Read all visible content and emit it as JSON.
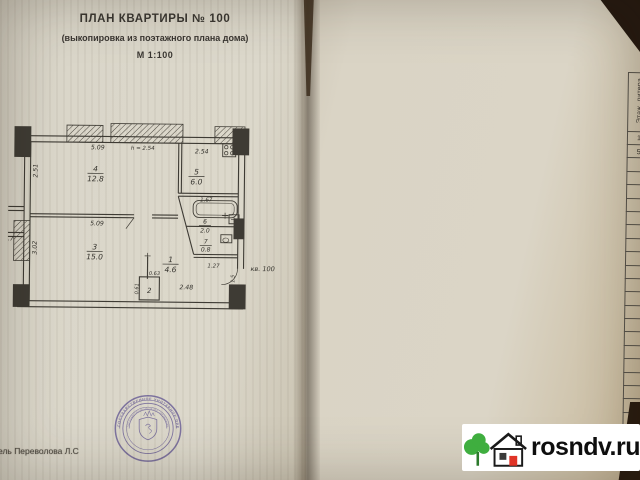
{
  "left_page": {
    "title": "ПЛАН КВАРТИРЫ № 100",
    "subtitle": "(выкопировка из поэтажного плана дома)",
    "scale": "М 1:100",
    "executor": "ель Переволова Л.С",
    "plan_labels": {
      "dim_top_room4": "5.09",
      "dim_height": "h = 2.54",
      "dim_top_kitchen": "2.54",
      "dim_left_room4": "2.51",
      "dim_left_room3": "3.02",
      "dim_mid_room3": "5.09",
      "dim_kitchen_bottom": "1.67",
      "dim_bath_width": "1.27",
      "dim_hall_width": "2.48",
      "dim_closet_w": "0.63",
      "dim_closet_h": "0.61",
      "dim_entry": "1.5",
      "dim_left_partial": "3.7",
      "apt_label": "кв. 100",
      "room4_num": "4",
      "room4_area": "12.8",
      "room5_num": "5",
      "room5_area": "6.0",
      "room3_num": "3",
      "room3_area": "15.0",
      "room1_num": "1",
      "room1_area": "4.6",
      "room6_num": "6",
      "room6_area": "2.0",
      "room7_num": "7",
      "room7_area": "0.8",
      "room2_num": "2"
    },
    "stamp": {
      "arc_text": "ГОСУДАРСТВЕННОЕ УНИТАРНОЕ ПРЕДПРИЯТИЕ",
      "inner_text": "ГОСУДАРСТВЕННЫЙ ЦЕНТР «НЕДВИЖИМОСТЬ»"
    }
  },
  "right_page": {
    "table_title": "II. Экспликация площади квартиры",
    "area_group": "Площадь",
    "columns": [
      "Этаж, литера",
      "Номер по плану здания комнат, кухни, корид. и т.д.",
      "Назначение частей помещения: жилая комната, кухня и т.п.",
      "Жилая",
      "Подсобная",
      "лоджий и пр. балконов, террас (с пониж. коэфф.)",
      "Высота помещений по внутреннему обмеру",
      "Самовольно переоборудованная площадь",
      "Примечание"
    ],
    "col_numbers": [
      "1",
      "2",
      "3",
      "4",
      "5",
      "6",
      "7",
      "8",
      "9"
    ],
    "rows": [
      [
        "5",
        "1",
        "прихожая",
        "",
        "4,6",
        "",
        "2,54",
        "",
        ""
      ],
      [
        "",
        "2",
        "встр.шкаф",
        "",
        "0,2",
        "",
        "",
        "",
        ""
      ],
      [
        "",
        "3",
        "жилая",
        "15,0",
        "",
        "",
        "",
        "",
        ""
      ],
      [
        "",
        "4",
        "жилая",
        "12,8",
        "",
        "",
        "",
        "",
        ""
      ],
      [
        "",
        "5",
        "кухня",
        "",
        "6,0",
        "",
        "",
        "",
        ""
      ],
      [
        "",
        "6",
        "ванная",
        "",
        "2,0",
        "",
        "",
        "",
        ""
      ],
      [
        "",
        "7",
        "туалет",
        "",
        "0,8",
        "",
        "",
        "",
        ""
      ],
      [
        "",
        "",
        "ИТОГО",
        "27,8",
        "13,6",
        "",
        "",
        "",
        ""
      ],
      [
        "",
        "",
        "балкон",
        "",
        "",
        "0,7",
        "",
        "",
        ""
      ]
    ],
    "empty_row_count": 14,
    "footer": [
      "Площадь квартиры",
      "Общая площадь квартиры"
    ]
  },
  "watermark": {
    "text": "rosndv.ru"
  }
}
